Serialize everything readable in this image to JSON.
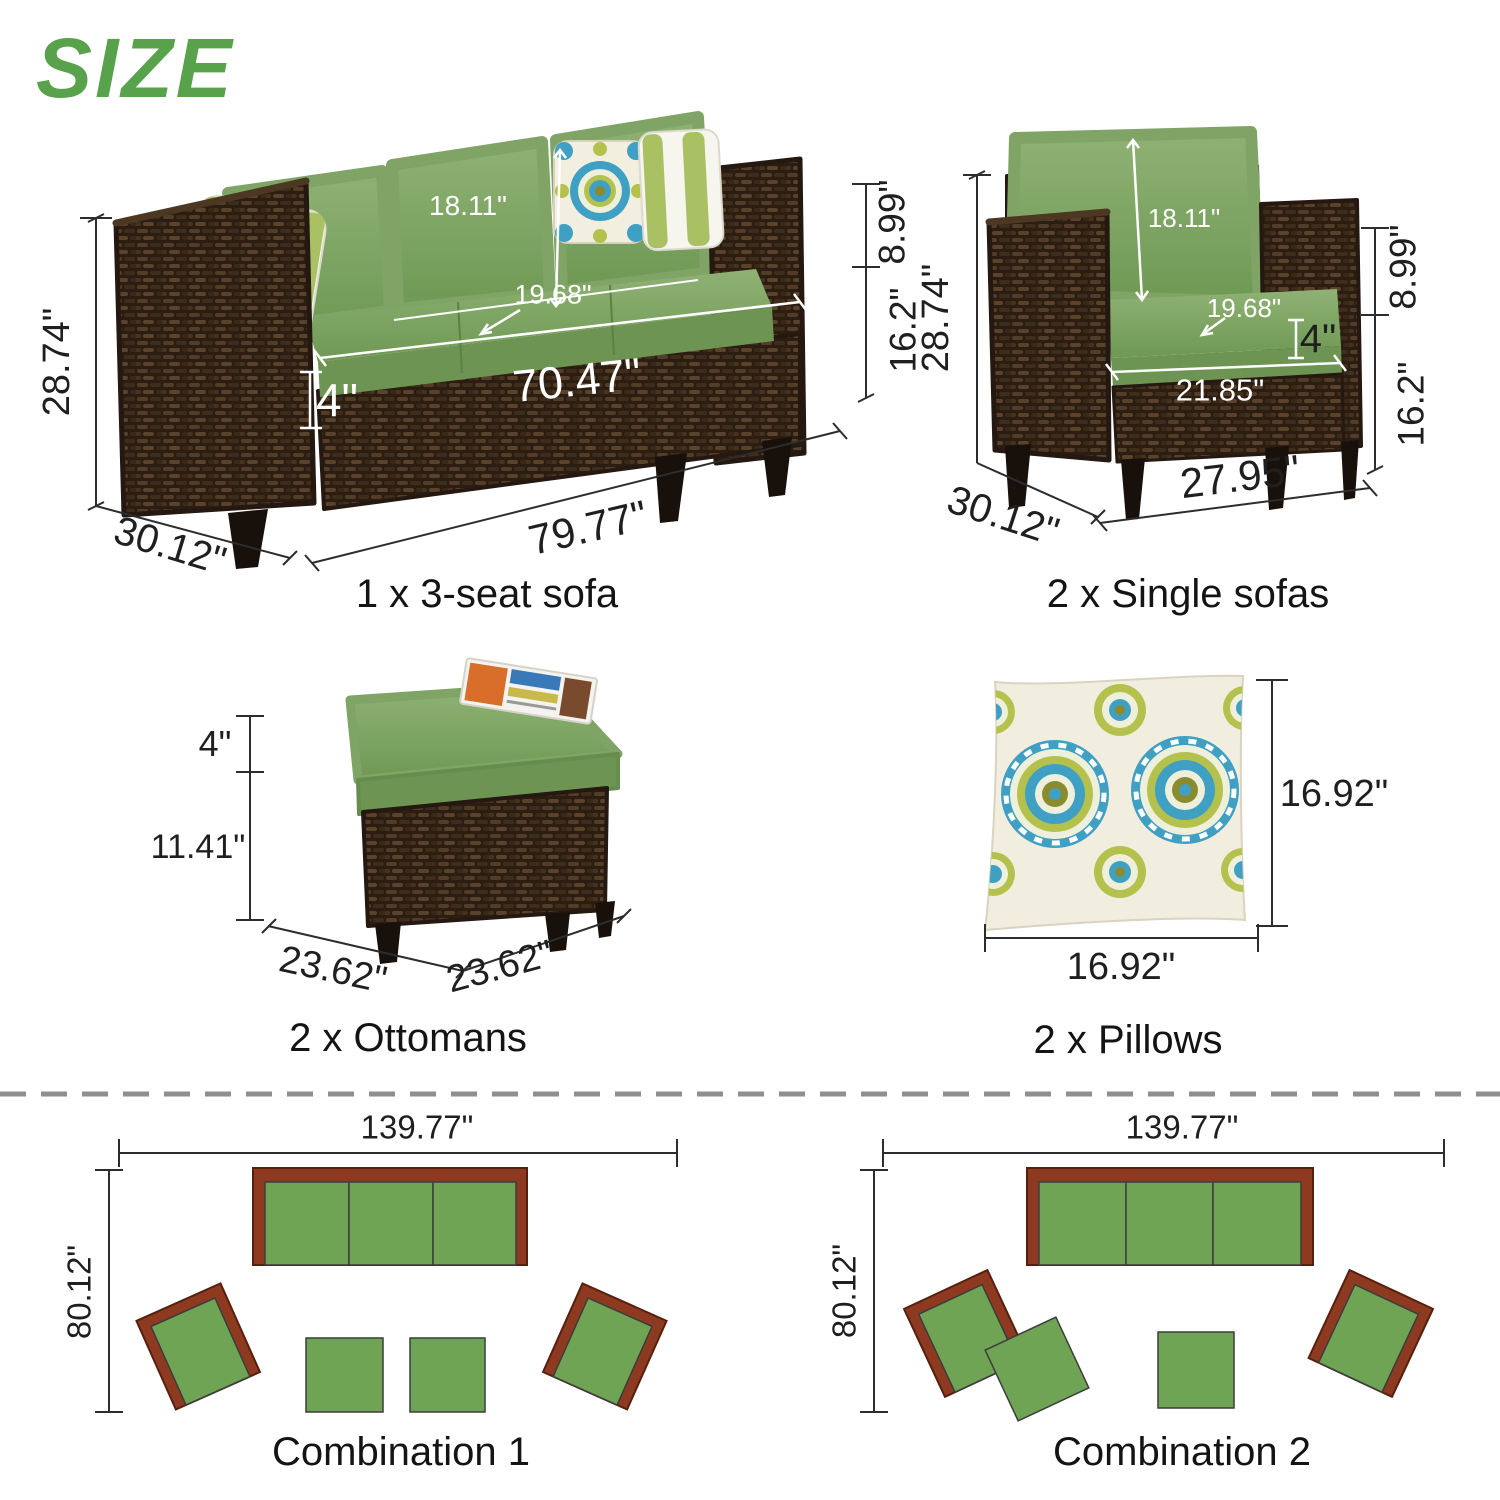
{
  "title": "SIZE",
  "colors": {
    "accent_green": "#57a24b",
    "cushion_green": "#7ba260",
    "wicker_brown": "#3a2a1d",
    "diagram_green": "#6fa455",
    "diagram_brown": "#8e3a20",
    "pillow_blue": "#3fa0c4",
    "pillow_lime": "#b5c14d"
  },
  "products": {
    "sofa": {
      "label": "1 x 3-seat sofa",
      "dims": {
        "overall_height": "28.74\"",
        "overall_depth": "30.12\"",
        "back_cushion_height": "18.11\"",
        "seat_depth": "19.68\"",
        "cushion_thickness": "4\"",
        "seat_width": "70.47\"",
        "overall_width": "79.77\"",
        "back_above_arm_height": "8.99\"",
        "arm_height": "16.2\""
      }
    },
    "single_sofa": {
      "label": "2 x Single sofas",
      "dims": {
        "overall_height": "28.74\"",
        "overall_depth": "30.12\"",
        "back_cushion_height": "18.11\"",
        "seat_depth": "19.68\"",
        "cushion_thickness": "4\"",
        "seat_width": "21.85\"",
        "overall_width": "27.95\"",
        "back_above_arm_height": "8.99\"",
        "arm_height": "16.2\""
      }
    },
    "ottoman": {
      "label": "2 x Ottomans",
      "dims": {
        "cushion_thickness": "4\"",
        "base_height": "11.41\"",
        "width": "23.62\"",
        "depth": "23.62\""
      }
    },
    "pillow": {
      "label": "2 x Pillows",
      "dims": {
        "height": "16.92\"",
        "width": "16.92\""
      }
    }
  },
  "combinations": [
    {
      "label": "Combination 1",
      "width": "139.77\"",
      "depth": "80.12\""
    },
    {
      "label": "Combination 2",
      "width": "139.77\"",
      "depth": "80.12\""
    }
  ]
}
